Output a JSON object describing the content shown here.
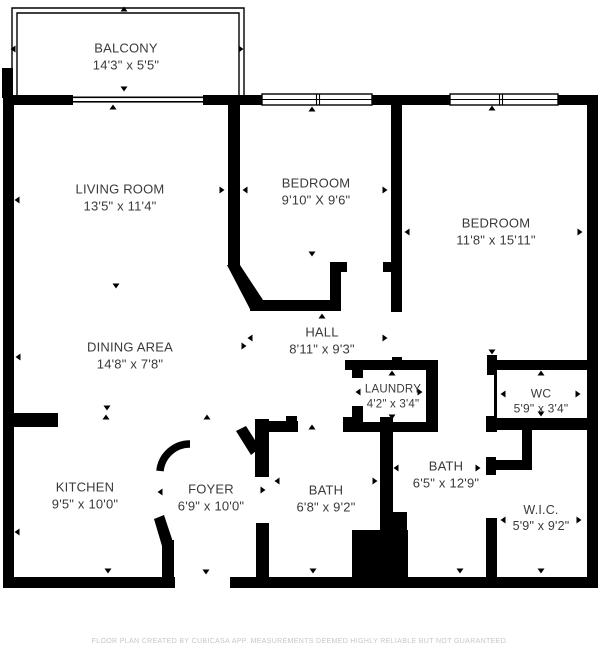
{
  "colors": {
    "wall": "#000000",
    "text": "#3a3a3a",
    "footer_text": "#c7c7c7",
    "background": "#ffffff"
  },
  "rooms": [
    {
      "id": "balcony",
      "name": "BALCONY",
      "dims": "14'3\" x 5'5\"",
      "cx": 126,
      "cy": 57,
      "font": 13
    },
    {
      "id": "living",
      "name": "LIVING ROOM",
      "dims": "13'5\" x 11'4\"",
      "cx": 120,
      "cy": 198,
      "font": 13
    },
    {
      "id": "bedroom1",
      "name": "BEDROOM",
      "dims": "9'10\" X 9'6\"",
      "cx": 316,
      "cy": 192,
      "font": 13
    },
    {
      "id": "bedroom2",
      "name": "BEDROOM",
      "dims": "11'8\" x 15'11\"",
      "cx": 496,
      "cy": 232,
      "font": 13
    },
    {
      "id": "dining",
      "name": "DINING AREA",
      "dims": "14'8\" x 7'8\"",
      "cx": 130,
      "cy": 356,
      "font": 13
    },
    {
      "id": "hall",
      "name": "HALL",
      "dims": "8'11\" x 9'3\"",
      "cx": 322,
      "cy": 341,
      "font": 13
    },
    {
      "id": "laundry",
      "name": "LAUNDRY",
      "dims": "4'2\" x 3'4\"",
      "cx": 393,
      "cy": 397,
      "font": 11.5
    },
    {
      "id": "wc",
      "name": "WC",
      "dims": "5'9\" x 3'4\"",
      "cx": 541,
      "cy": 402,
      "font": 12
    },
    {
      "id": "kitchen",
      "name": "KITCHEN",
      "dims": "9'5\" x 10'0\"",
      "cx": 85,
      "cy": 496,
      "font": 13
    },
    {
      "id": "foyer",
      "name": "FOYER",
      "dims": "6'9\" x 10'0\"",
      "cx": 211,
      "cy": 498,
      "font": 13
    },
    {
      "id": "bath1",
      "name": "BATH",
      "dims": "6'8\" x 9'2\"",
      "cx": 326,
      "cy": 499,
      "font": 13
    },
    {
      "id": "bath2",
      "name": "BATH",
      "dims": "6'5\" x 12'9\"",
      "cx": 446,
      "cy": 475,
      "font": 13
    },
    {
      "id": "wic",
      "name": "W.I.C.",
      "dims": "5'9\" x 9'2\"",
      "cx": 541,
      "cy": 518,
      "font": 12.5
    }
  ],
  "footer": {
    "disclaimer": "FLOOR PLAN CREATED BY CUBICASA APP. MEASUREMENTS DEEMED HIGHLY RELIABLE BUT NOT GUARANTEED."
  },
  "geometry": {
    "walls": [
      [
        3,
        95,
        70,
        10
      ],
      [
        203,
        95,
        59,
        10
      ],
      [
        372,
        95,
        78,
        10
      ],
      [
        558,
        95,
        40,
        10
      ],
      [
        3,
        95,
        11,
        493
      ],
      [
        587,
        95,
        11,
        493
      ],
      [
        3,
        577,
        172,
        11
      ],
      [
        230,
        577,
        368,
        11
      ],
      [
        2,
        68,
        11,
        30
      ],
      [
        228,
        105,
        12,
        162
      ],
      [
        250,
        300,
        91,
        11
      ],
      [
        330,
        262,
        11,
        49
      ],
      [
        330,
        262,
        17,
        10
      ],
      [
        383,
        262,
        19,
        10
      ],
      [
        391,
        105,
        11,
        207
      ],
      [
        392,
        357,
        10,
        13
      ],
      [
        345,
        360,
        93,
        10
      ],
      [
        352,
        370,
        11,
        8
      ],
      [
        352,
        406,
        11,
        26
      ],
      [
        426,
        360,
        12,
        72
      ],
      [
        343,
        417,
        15,
        15
      ],
      [
        343,
        422,
        95,
        10
      ],
      [
        265,
        421,
        33,
        11
      ],
      [
        286,
        416,
        11,
        6
      ],
      [
        255,
        419,
        14,
        58
      ],
      [
        256,
        523,
        13,
        55
      ],
      [
        162,
        540,
        12,
        38
      ],
      [
        3,
        413,
        55,
        14
      ],
      [
        380,
        417,
        13,
        113
      ],
      [
        352,
        530,
        56,
        48
      ],
      [
        380,
        512,
        27,
        66
      ],
      [
        487,
        355,
        10,
        20
      ],
      [
        487,
        360,
        100,
        10
      ],
      [
        486,
        416,
        11,
        16
      ],
      [
        487,
        418,
        100,
        12
      ],
      [
        522,
        430,
        10,
        40
      ],
      [
        486,
        457,
        10,
        18
      ],
      [
        489,
        460,
        43,
        10
      ],
      [
        486,
        518,
        11,
        59
      ]
    ],
    "polygons": [
      "227,265 240,265 263,300 251,311",
      "236,431 246,426 260,448 251,455",
      "154,519 164,515 173,542 162,546"
    ],
    "arcs": [
      {
        "d": "M 190 444 A 30 30 0 0 0 160 471",
        "width": 7.5
      }
    ],
    "thin_walls": [
      [
        494,
        370,
        3,
        48
      ]
    ],
    "railing": {
      "outer": "12,96 12,8 244,8 244,96",
      "inner": "17,96 17,13 239,13 239,96"
    },
    "sliding_door": [
      [
        73,
        96.5,
        130,
        1.6
      ],
      [
        73,
        101,
        130,
        1.6
      ]
    ],
    "windows": [
      {
        "x": 262,
        "y": 94,
        "w": 110,
        "h": 11,
        "mullions": [
          316.5,
          319.5
        ]
      },
      {
        "x": 450,
        "y": 94,
        "w": 108,
        "h": 11,
        "mullions": [
          499.5,
          502.5
        ]
      }
    ],
    "markers": [
      [
        124,
        9,
        "up"
      ],
      [
        13,
        49,
        "left"
      ],
      [
        241,
        49,
        "right"
      ],
      [
        124,
        89,
        "down"
      ],
      [
        113,
        107,
        "up"
      ],
      [
        17,
        200,
        "left"
      ],
      [
        222,
        190,
        "right"
      ],
      [
        116,
        286,
        "down"
      ],
      [
        312,
        109,
        "up"
      ],
      [
        245,
        190,
        "left"
      ],
      [
        385,
        190,
        "right"
      ],
      [
        312,
        254,
        "down"
      ],
      [
        492,
        108,
        "up"
      ],
      [
        407,
        232,
        "left"
      ],
      [
        580,
        232,
        "right"
      ],
      [
        492,
        352,
        "down"
      ],
      [
        18,
        357,
        "left"
      ],
      [
        244,
        346,
        "right"
      ],
      [
        107,
        408,
        "down"
      ],
      [
        250,
        338,
        "left"
      ],
      [
        385,
        338,
        "right"
      ],
      [
        322,
        316,
        "up"
      ],
      [
        358,
        392,
        "left"
      ],
      [
        420,
        392,
        "right"
      ],
      [
        392,
        373,
        "up"
      ],
      [
        392,
        417,
        "down"
      ],
      [
        503,
        394,
        "left"
      ],
      [
        578,
        394,
        "right"
      ],
      [
        541,
        373,
        "up"
      ],
      [
        541,
        414,
        "down"
      ],
      [
        17,
        532,
        "left"
      ],
      [
        108,
        571,
        "down"
      ],
      [
        106,
        417,
        "up"
      ],
      [
        160,
        492,
        "left"
      ],
      [
        263,
        490,
        "right"
      ],
      [
        207,
        417,
        "up"
      ],
      [
        206,
        572,
        "down"
      ],
      [
        277,
        481,
        "left"
      ],
      [
        375,
        481,
        "right"
      ],
      [
        312,
        427,
        "up"
      ],
      [
        313,
        571,
        "down"
      ],
      [
        396,
        468,
        "left"
      ],
      [
        478,
        468,
        "right"
      ],
      [
        460,
        571,
        "down"
      ],
      [
        503,
        520,
        "left"
      ],
      [
        579,
        520,
        "right"
      ],
      [
        541,
        571,
        "down"
      ]
    ]
  }
}
